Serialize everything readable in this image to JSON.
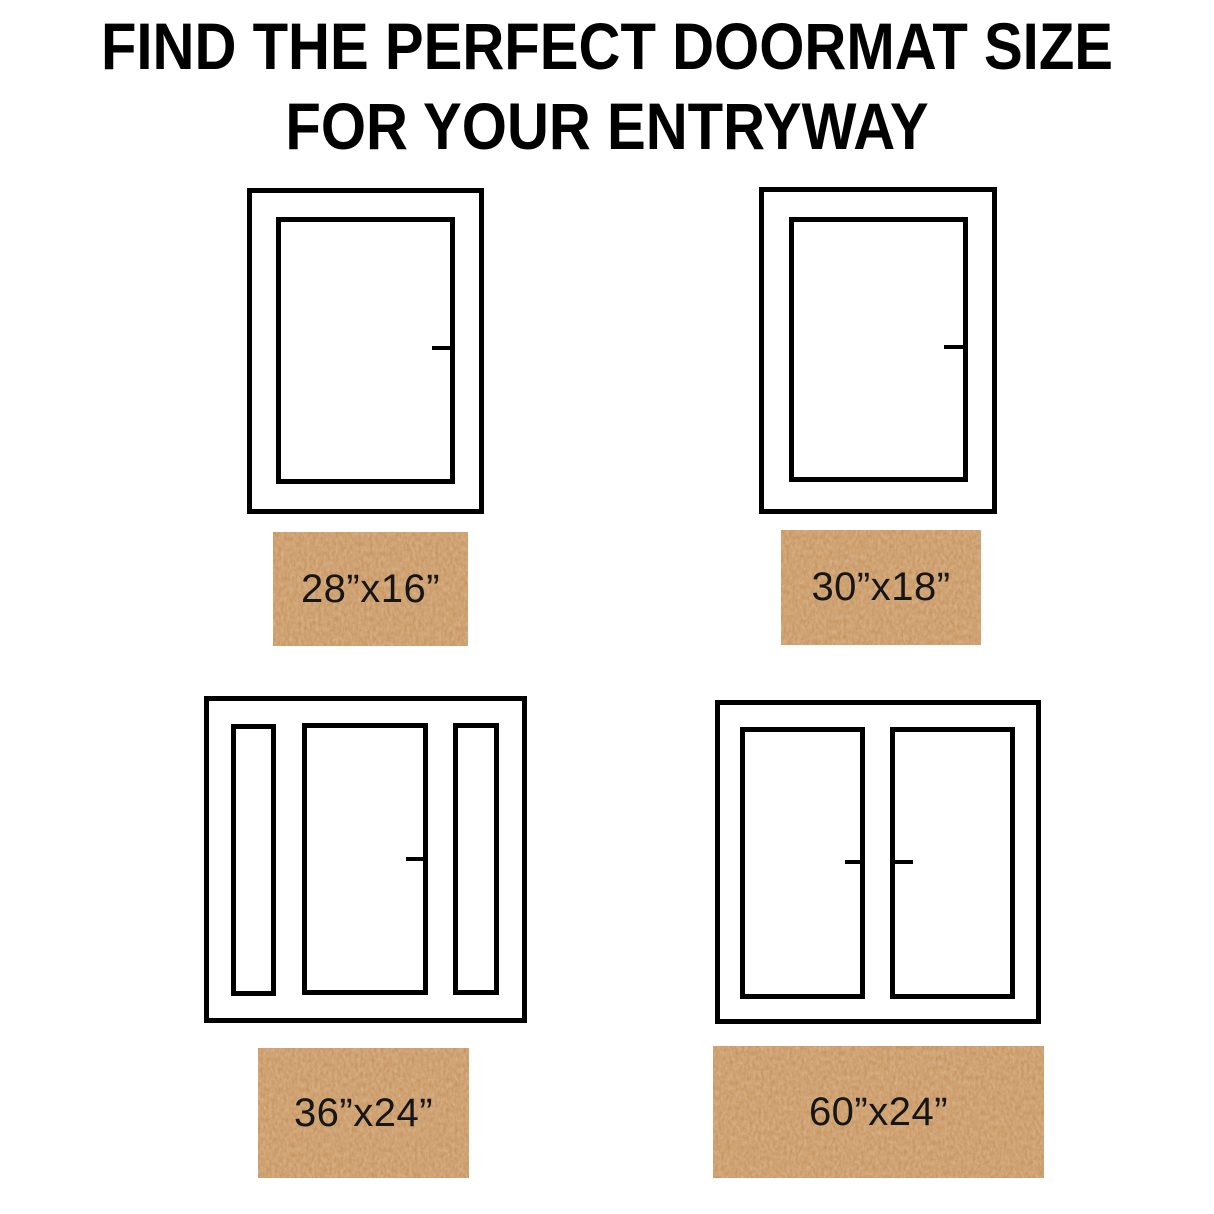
{
  "title": {
    "line1": "FIND THE PERFECT DOORMAT SIZE",
    "line2": "FOR YOUR ENTRYWAY"
  },
  "colors": {
    "page_bg": "#ffffff",
    "line": "#000000",
    "title_text": "#000000",
    "mat_base": "#c98a4c",
    "mat_text": "#161616"
  },
  "entries": [
    {
      "door_type": "single-door",
      "mat_label": "28”x16”"
    },
    {
      "door_type": "single-door",
      "mat_label": "30”x18”"
    },
    {
      "door_type": "door-with-sidelights",
      "mat_label": "36”x24”"
    },
    {
      "door_type": "double-door",
      "mat_label": "60”x24”"
    }
  ]
}
